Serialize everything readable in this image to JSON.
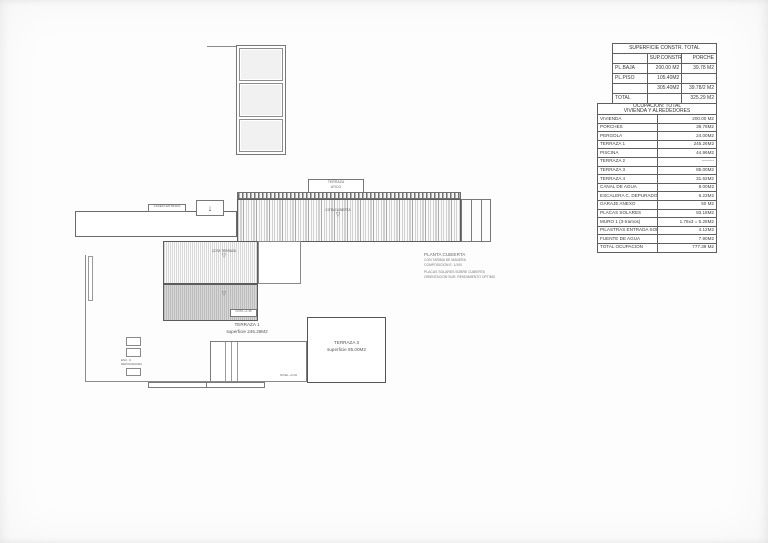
{
  "tables": {
    "construction": {
      "title": "SUPERFICIE CONSTR. TOTAL",
      "columns": [
        "",
        "SUP.CONSTR.",
        "PORCHE"
      ],
      "rows": [
        [
          "PL.BAJA",
          "200.00 M2",
          "39.78 M2"
        ],
        [
          "PL.PISO",
          "105.40M2",
          ""
        ],
        [
          "",
          "305.40M2",
          "39.78/2 M2"
        ],
        [
          "TOTAL",
          "",
          "325.29 M2"
        ]
      ]
    },
    "occupation": {
      "title_lines": [
        "OCUPACION:  TOTAL",
        "VIVIENDA Y ALREDEDORES"
      ],
      "rows": [
        [
          "VIVIENDA",
          "200.00 M2"
        ],
        [
          "PORCHES",
          "39.78M2"
        ],
        [
          "PERGOLA",
          "24.00M2"
        ],
        [
          "TERRAZA 1",
          "245.26M2"
        ],
        [
          "PISCINA",
          "44.96M2"
        ],
        [
          "TERRAZA 2",
          "--------"
        ],
        [
          "TERRAZA 3",
          "85.00M2"
        ],
        [
          "TERRAZA 4",
          "31.62M2"
        ],
        [
          "CANAL DE AGUA",
          "8.00M2"
        ],
        [
          "ESCALERA C. DEPURADORA",
          "6.23M2"
        ],
        [
          "GARAJE ANEXO",
          "50 M2"
        ],
        [
          "PLACAS SOLARES",
          "93.18M2"
        ],
        [
          "MURO 1  (3-tramos)",
          "1.76x3 = 5.28M2"
        ],
        [
          "PILASTRAS ENTRADA SOL.AR",
          "4.12M2"
        ],
        [
          "FUENTE DE AGUA",
          "7.90M2"
        ],
        [
          "TOTAL  OCUPACION",
          "777.39 M2"
        ]
      ]
    }
  },
  "plan": {
    "roof_box_label": [
      "TERRAZA",
      "ATICO"
    ],
    "entry_box_label": "CASETA ENTRADA",
    "arrow_down": "↓",
    "elevation_symbol": "▽",
    "roof_marker_label": "COTA CUBIERTA",
    "lower_marker_label": "COTA TERRAZA",
    "terraza1_tag": "COTA +1.45",
    "terraza1_caption": [
      "TERRAZA 1",
      "superficie  245.26M2"
    ],
    "terraza3_caption": [
      "TERRAZA 3",
      "superficie  85.00M2"
    ],
    "pump_note": [
      "ESC. C.",
      "DEPURADORA"
    ],
    "level_note": "NIVEL +0.00",
    "notes": {
      "title": "PLANTA  CUBIERTA",
      "lines": [
        "CON TARIMA DE MADERA",
        "COMPOSICION  E: 1/100",
        "PLACAS SOLARES SOBRE CUBIERTA",
        "ORIENTACION SUR. RENDIMIENTO OPTIMO"
      ]
    }
  }
}
